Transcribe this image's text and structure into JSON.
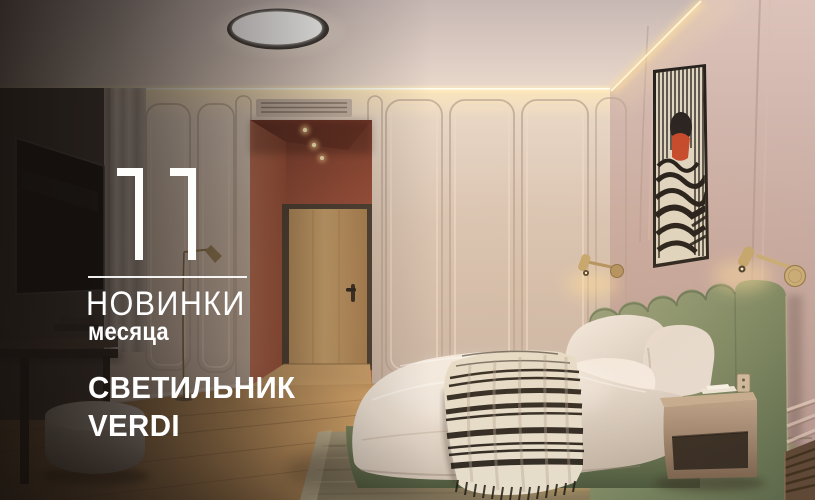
{
  "promo": {
    "number": "11",
    "title": "НОВИНКИ",
    "subtitle": "месяца",
    "product_line1": "СВЕТИЛЬНИК",
    "product_line2": "VERDI"
  },
  "colors": {
    "text": "#ffffff",
    "terracotta_wall": "#a4523d",
    "beige_wall": "#d8c5b6",
    "mauve_wall": "#c8aba2",
    "headboard_green": "#7e8964",
    "wood_floor": "#cf9f66",
    "led_glow": "#ffe7b8",
    "blanket_stripe": "#221c16"
  }
}
